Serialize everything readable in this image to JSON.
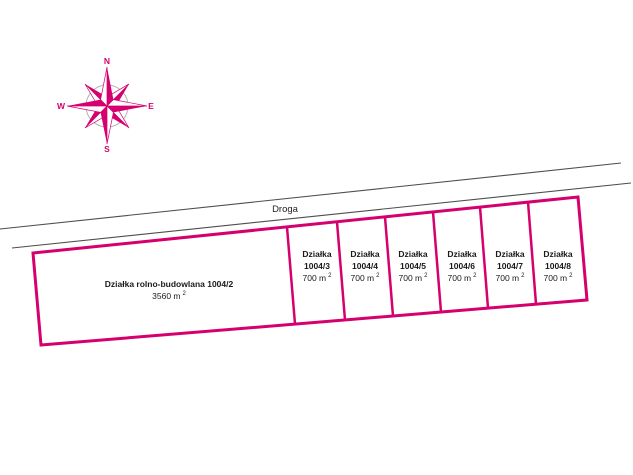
{
  "colors": {
    "accent": "#D5006E",
    "road_line": "#4d4d4d",
    "text": "#1a1a1a",
    "compass_ring": "#b3b3b3"
  },
  "compass": {
    "north": "N",
    "east": "E",
    "south": "S",
    "west": "W"
  },
  "road": {
    "label": "Droga"
  },
  "main_plot": {
    "title": "Działka rolno-budowlana 1004/2",
    "area_value": "3560 m",
    "area_sup": "2"
  },
  "plots": [
    {
      "label": "Działka",
      "number": "1004/3",
      "area_value": "700 m",
      "area_sup": "2"
    },
    {
      "label": "Działka",
      "number": "1004/4",
      "area_value": "700 m",
      "area_sup": "2"
    },
    {
      "label": "Działka",
      "number": "1004/5",
      "area_value": "700 m",
      "area_sup": "2"
    },
    {
      "label": "Działka",
      "number": "1004/6",
      "area_value": "700 m",
      "area_sup": "2"
    },
    {
      "label": "Działka",
      "number": "1004/7",
      "area_value": "700 m",
      "area_sup": "2"
    },
    {
      "label": "Działka",
      "number": "1004/8",
      "area_value": "700 m",
      "area_sup": "2"
    }
  ]
}
